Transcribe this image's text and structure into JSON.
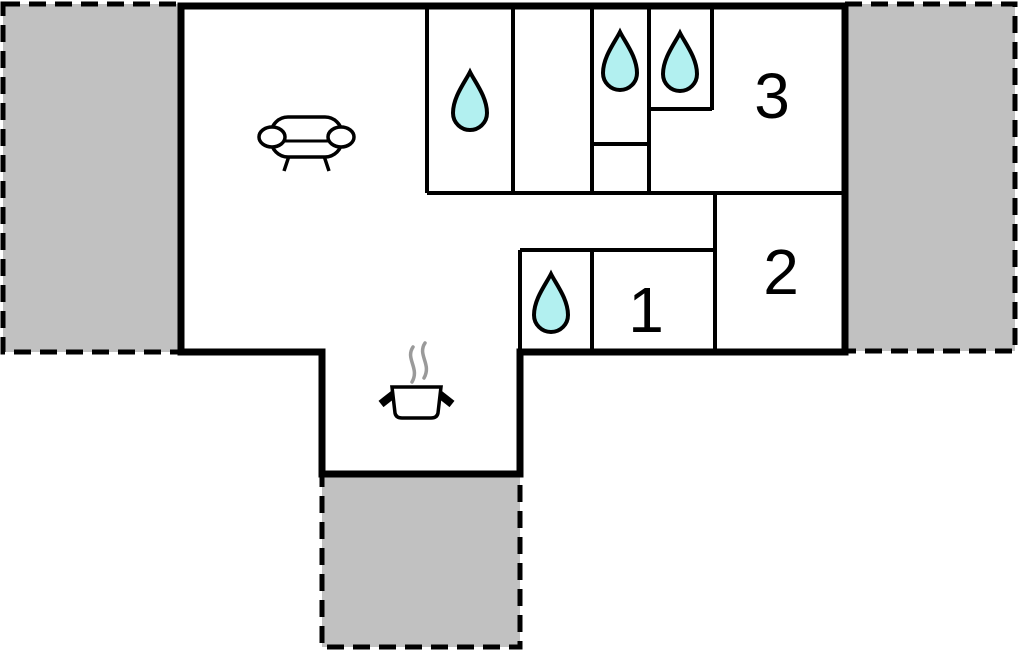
{
  "floorplan": {
    "room_labels": {
      "room1": "1",
      "room2": "2",
      "room3": "3"
    },
    "icon_names": [
      "sofa-icon",
      "water-drop-icon",
      "cooking-pot-icon",
      "steam-icon"
    ],
    "water_drop_count": 4,
    "colors": {
      "wall": "#000000",
      "terrace_fill": "#c1c1c1",
      "water_drop_fill": "#b2f0f0",
      "steam": "#9a9a9a",
      "background": "#ffffff"
    }
  }
}
